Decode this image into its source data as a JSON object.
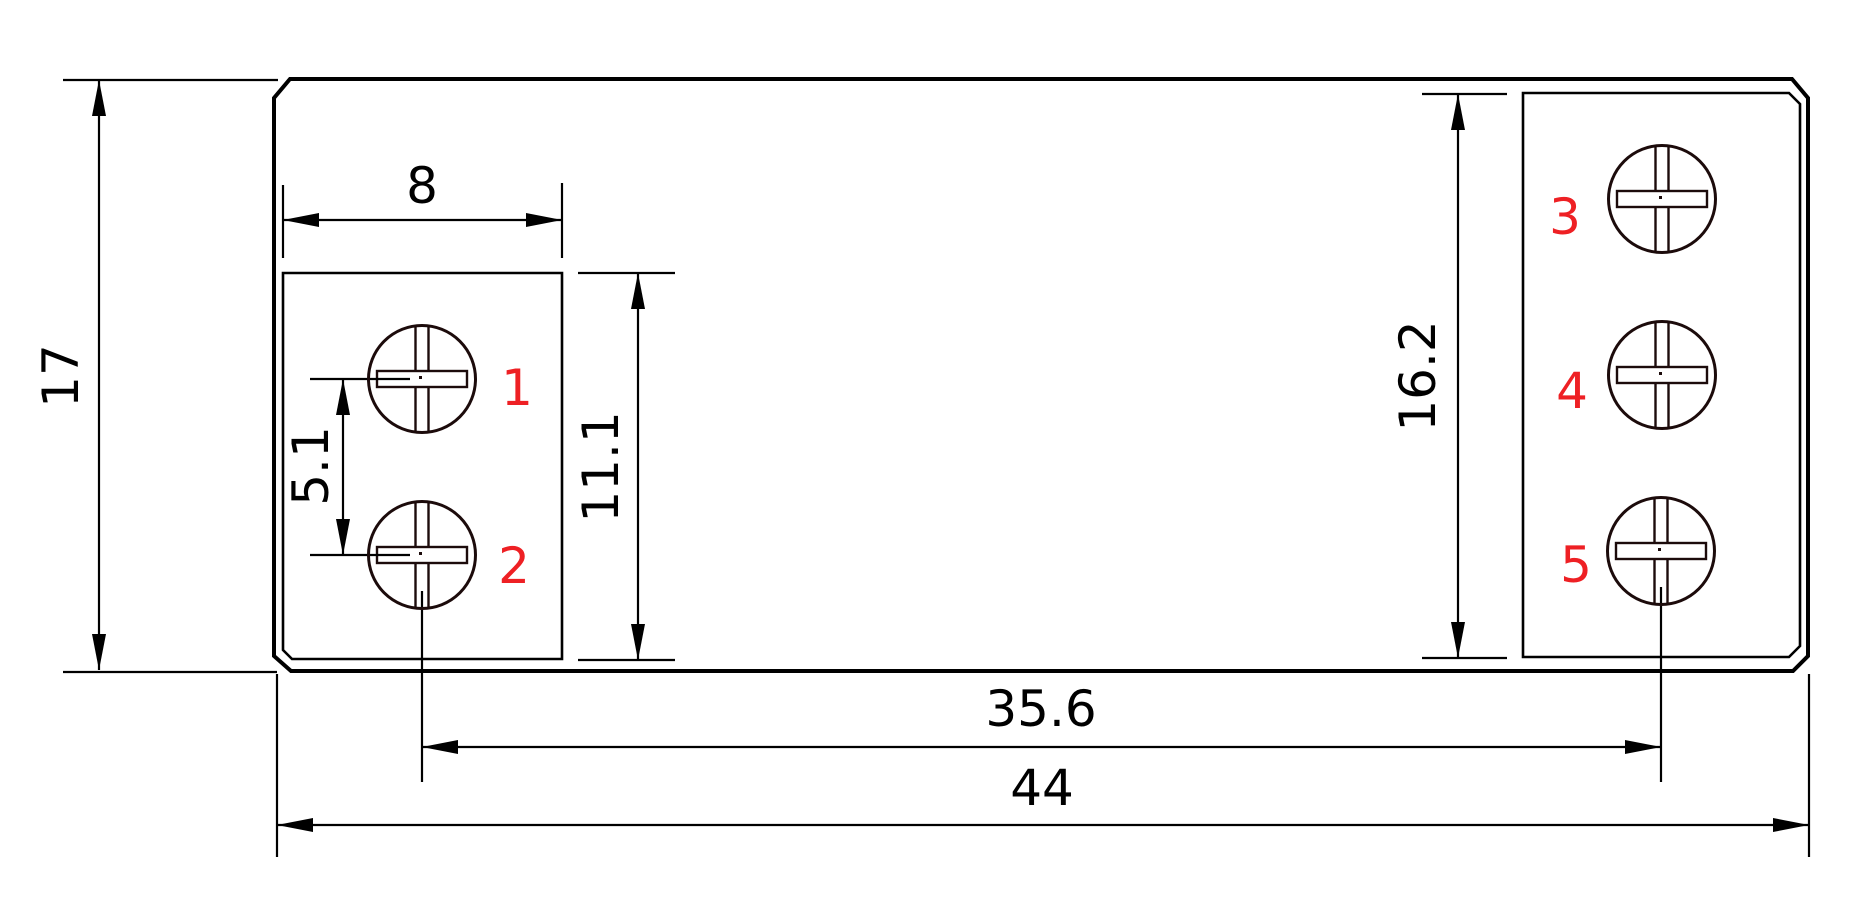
{
  "drawing": {
    "type": "technical-dimension-drawing",
    "colors": {
      "line": "#000000",
      "screw_outline": "#1c0b0b",
      "label_red": "#ee2024",
      "background": "#ffffff"
    },
    "dims": {
      "overall_width": "44",
      "overall_height": "17",
      "left_block_width": "8",
      "left_block_height": "11.1",
      "terminal_pitch": "5.1",
      "right_block_height": "16.2",
      "terminal_span": "35.6"
    },
    "terminals": [
      "1",
      "2",
      "3",
      "4",
      "5"
    ]
  }
}
